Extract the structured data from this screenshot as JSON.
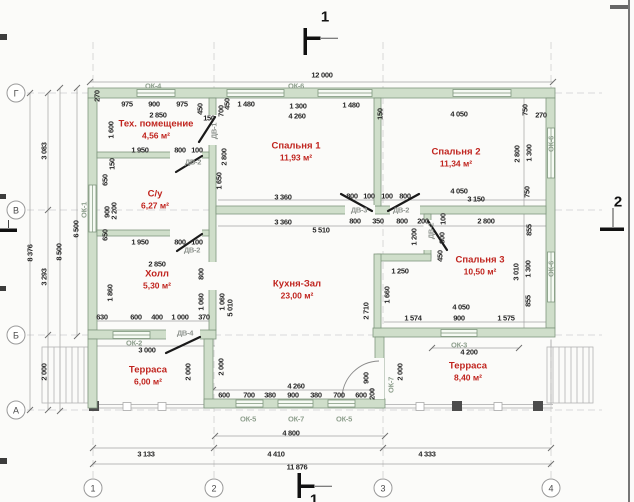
{
  "drawing": {
    "sections": {
      "top": "1",
      "right": "2",
      "bottom": "1"
    },
    "axes_left": [
      [
        "Г",
        93
      ],
      [
        "В",
        210
      ],
      [
        "Б",
        335
      ],
      [
        "А",
        410
      ]
    ],
    "axes_bottom": [
      [
        "1",
        93
      ],
      [
        "2",
        214
      ],
      [
        "3",
        383
      ],
      [
        "4",
        551
      ]
    ],
    "rooms": [
      {
        "name": "Тех. помещение",
        "area": "4,56 м²",
        "x": 156,
        "y": 130
      },
      {
        "name": "С/у",
        "area": "6,27 м²",
        "x": 155,
        "y": 200
      },
      {
        "name": "Холл",
        "area": "5,30 м²",
        "x": 157,
        "y": 280
      },
      {
        "name": "Спальня 1",
        "area": "11,93 м²",
        "x": 296,
        "y": 152
      },
      {
        "name": "Спальня 2",
        "area": "11,34 м²",
        "x": 456,
        "y": 158
      },
      {
        "name": "Спальня 3",
        "area": "10,50 м²",
        "x": 480,
        "y": 266
      },
      {
        "name": "Кухня-Зал",
        "area": "23,00 м²",
        "x": 297,
        "y": 290
      },
      {
        "name": "Терраса",
        "area": "6,00 м²",
        "x": 148,
        "y": 376
      },
      {
        "name": "Терраса",
        "area": "8,40 м²",
        "x": 468,
        "y": 372
      }
    ],
    "labels": [
      [
        "12 000",
        322,
        75,
        "d",
        0
      ],
      [
        "975",
        127,
        104,
        "d",
        0
      ],
      [
        "900",
        154,
        104,
        "d",
        0
      ],
      [
        "975",
        182,
        104,
        "d",
        0
      ],
      [
        "1 480",
        246,
        104,
        "d",
        0
      ],
      [
        "1 300",
        298,
        106,
        "d",
        0
      ],
      [
        "1 480",
        351,
        105,
        "d",
        0
      ],
      [
        "4 050",
        459,
        114,
        "d",
        0
      ],
      [
        "2 850",
        158,
        115,
        "d",
        0
      ],
      [
        "4 260",
        297,
        116,
        "d",
        0
      ],
      [
        "270",
        97,
        96,
        "d",
        1
      ],
      [
        "450",
        200,
        109,
        "d",
        1
      ],
      [
        "150",
        209,
        118,
        "d",
        0
      ],
      [
        "700",
        221,
        111,
        "d",
        1
      ],
      [
        "450",
        227,
        104,
        "d",
        1
      ],
      [
        "150",
        380,
        114,
        "d",
        1
      ],
      [
        "750",
        525,
        110,
        "d",
        1
      ],
      [
        "270",
        541,
        115,
        "d",
        0
      ],
      [
        "1 600",
        111,
        130,
        "d",
        1
      ],
      [
        "1 950",
        140,
        150,
        "d",
        0
      ],
      [
        "800",
        180,
        150,
        "d",
        0
      ],
      [
        "100",
        197,
        150,
        "d",
        0
      ],
      [
        "2 800",
        224,
        157,
        "d",
        1
      ],
      [
        "1 650",
        219,
        181,
        "d",
        1
      ],
      [
        "2 800",
        517,
        154,
        "d",
        1
      ],
      [
        "1 300",
        529,
        153,
        "d",
        1
      ],
      [
        "150",
        112,
        164,
        "d",
        1
      ],
      [
        "650",
        105,
        180,
        "d",
        1
      ],
      [
        "900",
        107,
        212,
        "d",
        1
      ],
      [
        "2 200",
        114,
        211,
        "d",
        1
      ],
      [
        "650",
        105,
        235,
        "d",
        1
      ],
      [
        "1 950",
        140,
        242,
        "d",
        0
      ],
      [
        "800",
        180,
        242,
        "d",
        0
      ],
      [
        "100",
        197,
        242,
        "d",
        0
      ],
      [
        "3 360",
        283,
        197,
        "d",
        0
      ],
      [
        "3 360",
        283,
        222,
        "d",
        0
      ],
      [
        "800",
        352,
        196,
        "d",
        0
      ],
      [
        "100",
        369,
        196,
        "d",
        0
      ],
      [
        "100",
        387,
        196,
        "d",
        0
      ],
      [
        "800",
        405,
        196,
        "d",
        0
      ],
      [
        "4 050",
        459,
        191,
        "d",
        0
      ],
      [
        "3 150",
        476,
        199,
        "d",
        0
      ],
      [
        "800",
        355,
        221,
        "d",
        0
      ],
      [
        "350",
        378,
        221,
        "d",
        0
      ],
      [
        "800",
        402,
        221,
        "d",
        0
      ],
      [
        "200",
        423,
        221,
        "d",
        0
      ],
      [
        "2 800",
        486,
        221,
        "d",
        0
      ],
      [
        "5 510",
        321,
        230,
        "d",
        0
      ],
      [
        "2 850",
        157,
        264,
        "d",
        0
      ],
      [
        "800",
        201,
        274,
        "d",
        1
      ],
      [
        "1 860",
        110,
        293,
        "d",
        1
      ],
      [
        "1 200",
        414,
        237,
        "d",
        1
      ],
      [
        "100",
        443,
        219,
        "d",
        1
      ],
      [
        "800",
        442,
        238,
        "d",
        1
      ],
      [
        "450",
        440,
        256,
        "d",
        1
      ],
      [
        "1 250",
        400,
        271,
        "d",
        0
      ],
      [
        "1 660",
        387,
        295,
        "d",
        1
      ],
      [
        "2 710",
        366,
        311,
        "d",
        1
      ],
      [
        "1 060",
        201,
        302,
        "d",
        1
      ],
      [
        "1 060",
        222,
        302,
        "d",
        1
      ],
      [
        "5 010",
        230,
        308,
        "d",
        1
      ],
      [
        "630",
        102,
        317,
        "d",
        0
      ],
      [
        "600",
        136,
        317,
        "d",
        0
      ],
      [
        "400",
        157,
        317,
        "d",
        0
      ],
      [
        "1 000",
        180,
        317,
        "d",
        0
      ],
      [
        "370",
        204,
        317,
        "d",
        0
      ],
      [
        "4 050",
        461,
        307,
        "d",
        0
      ],
      [
        "1 574",
        413,
        318,
        "d",
        0
      ],
      [
        "900",
        459,
        318,
        "d",
        0
      ],
      [
        "1 575",
        506,
        318,
        "d",
        0
      ],
      [
        "750",
        527,
        192,
        "d",
        1
      ],
      [
        "855",
        529,
        230,
        "d",
        1
      ],
      [
        "3 010",
        516,
        272,
        "d",
        1
      ],
      [
        "1 300",
        528,
        269,
        "d",
        1
      ],
      [
        "855",
        528,
        301,
        "d",
        1
      ],
      [
        "3 000",
        147,
        350,
        "d",
        0
      ],
      [
        "2 000",
        188,
        372,
        "d",
        1
      ],
      [
        "2 000",
        221,
        367,
        "d",
        1
      ],
      [
        "2 000",
        400,
        372,
        "d",
        1
      ],
      [
        "4 260",
        296,
        386,
        "d",
        0
      ],
      [
        "600",
        224,
        395,
        "d",
        0
      ],
      [
        "700",
        249,
        395,
        "d",
        0
      ],
      [
        "380",
        270,
        395,
        "d",
        0
      ],
      [
        "900",
        293,
        395,
        "d",
        0
      ],
      [
        "380",
        316,
        395,
        "d",
        0
      ],
      [
        "700",
        339,
        395,
        "d",
        0
      ],
      [
        "600",
        361,
        395,
        "d",
        0
      ],
      [
        "900",
        366,
        378,
        "d",
        1
      ],
      [
        "200",
        372,
        394,
        "d",
        1
      ],
      [
        "4 200",
        469,
        352,
        "d",
        0
      ],
      [
        "4 800",
        291,
        433,
        "d",
        0
      ],
      [
        "3 133",
        146,
        454,
        "d",
        0
      ],
      [
        "4 410",
        276,
        454,
        "d",
        0
      ],
      [
        "4 333",
        427,
        454,
        "d",
        0
      ],
      [
        "11 876",
        297,
        467,
        "d",
        0
      ],
      [
        "8 376",
        30,
        253,
        "d",
        1
      ],
      [
        "3 083",
        44,
        151,
        "d",
        1
      ],
      [
        "3 293",
        44,
        277,
        "d",
        1
      ],
      [
        "2 000",
        44,
        372,
        "d",
        1
      ],
      [
        "8 500",
        59,
        252,
        "d",
        1
      ],
      [
        "6 500",
        76,
        229,
        "d",
        1
      ],
      [
        "ОК-4",
        153,
        86,
        "w",
        0
      ],
      [
        "ОК-6",
        296,
        86,
        "w",
        0
      ],
      [
        "ОК-1",
        84,
        210,
        "w",
        1
      ],
      [
        "ОК-6",
        551,
        144,
        "w",
        1
      ],
      [
        "ОК-6",
        551,
        269,
        "w",
        1
      ],
      [
        "ОК-2",
        134,
        343,
        "w",
        0
      ],
      [
        "ОК-3",
        459,
        345,
        "w",
        0
      ],
      [
        "ОК-5",
        248,
        419,
        "w",
        0
      ],
      [
        "ОК-7",
        296,
        419,
        "w",
        0
      ],
      [
        "ОК-5",
        344,
        419,
        "w",
        0
      ],
      [
        "ОК-7",
        391,
        385,
        "w",
        1
      ],
      [
        "ДВ-1",
        214,
        131,
        "dr",
        1
      ],
      [
        "ДВ-2",
        193,
        162,
        "dr",
        0
      ],
      [
        "ДВ-2",
        192,
        250,
        "dr",
        0
      ],
      [
        "ДВ-3",
        359,
        210,
        "dr",
        0
      ],
      [
        "ДВ-2",
        401,
        210,
        "dr",
        0
      ],
      [
        "ДВ-2",
        431,
        231,
        "dr",
        1
      ],
      [
        "ДВ-4",
        185,
        333,
        "dr",
        0
      ]
    ],
    "colors": {
      "wall": "#cfdeca",
      "wall_edge": "#7f967d",
      "room_text": "#c0241e",
      "dim_text": "#262626"
    }
  }
}
